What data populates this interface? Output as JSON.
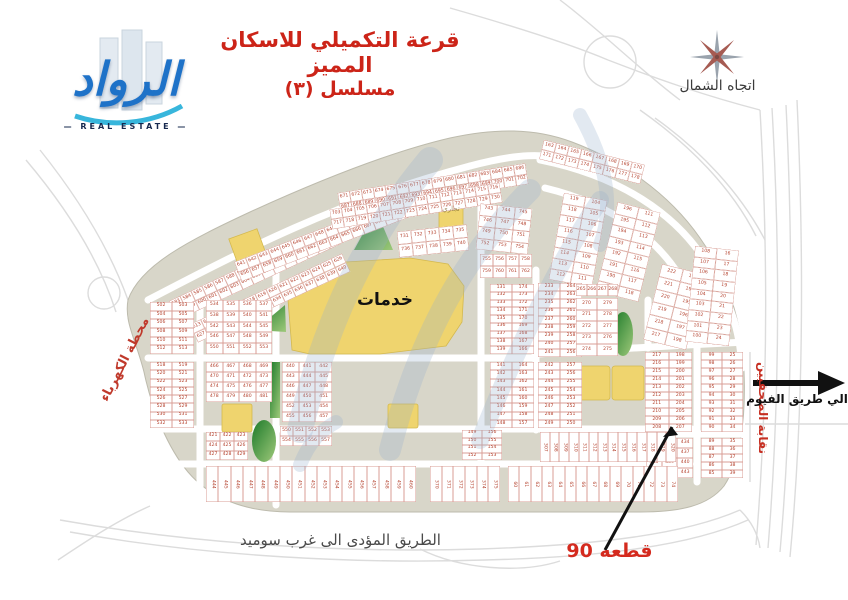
{
  "title": {
    "line1": "قرعة التكميلي للاسكان المميز",
    "line2": "مسلسل (٣)",
    "color": "#cc2418"
  },
  "branding": {
    "logo_text": "الرواد",
    "logo_sub": "REAL ESTATE"
  },
  "compass": {
    "label": "اتجاه الشمال"
  },
  "labels": {
    "services": "خدمات",
    "commercial": "تجاري",
    "power_station": "محطة الكهرباء",
    "journalists_syndicate": "نقابة الصحفيين",
    "to_fayoum_road": "الي طريق الفيوم",
    "road_to_west_sumid": "الطريق المؤدى الى غرب سوميد",
    "plot_90": "قطعه 90"
  },
  "colors": {
    "parcel_fill": "#d8d6c9",
    "parcel_edge": "#bdbbad",
    "road": "#ffffff",
    "highway": "#dcdcdc",
    "plot_number": "#b5432f",
    "plot_border": "rgba(178,62,44,0.5)",
    "services_yellow": "#efd46e",
    "green_dark": "#1d7a2a",
    "green_light": "#9ec97a",
    "watermark": "rgba(150,175,205,0.28)",
    "title_red": "#cc2418",
    "arrow_black": "#111111"
  },
  "map": {
    "blocks": [
      {
        "name": "strip-a",
        "x": 165,
        "y": 262,
        "w": 180,
        "h": 21,
        "rot": -25,
        "rows": 2,
        "cols": 15,
        "from": 583,
        "step": 1
      },
      {
        "name": "strip-b",
        "x": 186,
        "y": 288,
        "w": 168,
        "h": 20,
        "rot": -25,
        "rows": 2,
        "cols": 14,
        "from": 613,
        "step": 1
      },
      {
        "name": "strip-c",
        "x": 232,
        "y": 229,
        "w": 180,
        "h": 21,
        "rot": -21,
        "rows": 2,
        "cols": 15,
        "from": 641,
        "step": 1
      },
      {
        "name": "strip-d",
        "x": 338,
        "y": 178,
        "w": 190,
        "h": 21,
        "rot": -9,
        "rows": 2,
        "cols": 16,
        "from": 671,
        "step": 1
      },
      {
        "name": "strip-e",
        "x": 330,
        "y": 196,
        "w": 172,
        "h": 20,
        "rot": -9,
        "rows": 2,
        "cols": 14,
        "from": 703,
        "step": 1
      },
      {
        "name": "strip-f",
        "x": 540,
        "y": 152,
        "w": 104,
        "h": 20,
        "rot": 14,
        "rows": 2,
        "cols": 8,
        "from": 163,
        "step": 1
      },
      {
        "name": "tr-block-1",
        "x": 556,
        "y": 196,
        "w": 44,
        "h": 88,
        "rot": 10,
        "rows": 8,
        "cols": 2,
        "columns": [
          {
            "from": 119,
            "step": -1
          },
          {
            "from": 104,
            "step": 1
          }
        ]
      },
      {
        "name": "tr-block-2",
        "x": 606,
        "y": 206,
        "w": 44,
        "h": 92,
        "rot": 14,
        "rows": 8,
        "cols": 2,
        "columns": [
          {
            "from": 196,
            "step": -1
          },
          {
            "from": 111,
            "step": 1
          }
        ]
      },
      {
        "name": "arc-block-1",
        "x": 652,
        "y": 268,
        "w": 44,
        "h": 78,
        "rot": 14,
        "rows": 6,
        "cols": 2,
        "columns": [
          {
            "from": 222,
            "step": -1
          },
          {
            "from": 193,
            "step": 1
          }
        ]
      },
      {
        "name": "arc-block-2",
        "x": 690,
        "y": 248,
        "w": 44,
        "h": 96,
        "rot": 6,
        "rows": 9,
        "cols": 2,
        "columns": [
          {
            "from": 108,
            "step": -1
          },
          {
            "from": 16,
            "step": 1
          }
        ]
      },
      {
        "name": "right-col-1",
        "x": 645,
        "y": 352,
        "w": 47,
        "h": 80,
        "rows": 10,
        "cols": 2,
        "columns": [
          {
            "from": 217,
            "step": -1
          },
          {
            "from": 198,
            "step": 1
          }
        ]
      },
      {
        "name": "right-col-2",
        "x": 701,
        "y": 352,
        "w": 42,
        "h": 80,
        "rows": 10,
        "cols": 2,
        "columns": [
          {
            "from": 99,
            "step": -1
          },
          {
            "from": 25,
            "step": 1
          }
        ]
      },
      {
        "name": "right-col-3",
        "x": 701,
        "y": 438,
        "w": 42,
        "h": 40,
        "rows": 5,
        "cols": 2,
        "columns": [
          {
            "from": 89,
            "step": -1
          },
          {
            "from": 35,
            "step": 1
          }
        ]
      },
      {
        "name": "right-small",
        "x": 646,
        "y": 438,
        "w": 47,
        "h": 40,
        "rows": 4,
        "cols": 3,
        "from": 432,
        "step": 1
      },
      {
        "name": "center-col-1",
        "x": 490,
        "y": 284,
        "w": 44,
        "h": 70,
        "rows": 9,
        "cols": 2,
        "columns": [
          {
            "from": 131,
            "step": 1
          },
          {
            "from": 174,
            "step": -1
          }
        ]
      },
      {
        "name": "center-col-2",
        "x": 490,
        "y": 362,
        "w": 44,
        "h": 66,
        "rows": 8,
        "cols": 2,
        "columns": [
          {
            "from": 141,
            "step": 1
          },
          {
            "from": 164,
            "step": -1
          }
        ]
      },
      {
        "name": "center-col-3",
        "x": 462,
        "y": 430,
        "w": 40,
        "h": 30,
        "rows": 4,
        "cols": 2,
        "columns": [
          {
            "from": 149,
            "step": 1
          },
          {
            "from": 156,
            "step": -1
          }
        ]
      },
      {
        "name": "mid-col-1",
        "x": 538,
        "y": 283,
        "w": 44,
        "h": 74,
        "rows": 9,
        "cols": 2,
        "columns": [
          {
            "from": 233,
            "step": 1
          },
          {
            "from": 264,
            "step": -1
          }
        ]
      },
      {
        "name": "mid-col-2",
        "x": 538,
        "y": 362,
        "w": 44,
        "h": 66,
        "rows": 8,
        "cols": 2,
        "columns": [
          {
            "from": 242,
            "step": 1
          },
          {
            "from": 257,
            "step": -1
          }
        ]
      },
      {
        "name": "arch-cap",
        "x": 576,
        "y": 284,
        "w": 42,
        "h": 12,
        "rows": 1,
        "cols": 4,
        "from": 265,
        "step": 1
      },
      {
        "name": "arch-block",
        "x": 576,
        "y": 298,
        "w": 42,
        "h": 58,
        "rows": 5,
        "cols": 2,
        "columns": [
          {
            "from": 270,
            "step": 1
          },
          {
            "from": 279,
            "step": -1
          }
        ]
      },
      {
        "name": "left-col-1",
        "x": 150,
        "y": 302,
        "w": 44,
        "h": 52,
        "rows": 6,
        "cols": 2,
        "from": 502,
        "step": 1
      },
      {
        "name": "left-col-2",
        "x": 150,
        "y": 362,
        "w": 44,
        "h": 66,
        "rows": 8,
        "cols": 2,
        "from": 518,
        "step": 1
      },
      {
        "name": "left-grid-1",
        "x": 206,
        "y": 300,
        "w": 66,
        "h": 54,
        "rows": 5,
        "cols": 4,
        "from": 534,
        "step": 1
      },
      {
        "name": "left-grid-2",
        "x": 206,
        "y": 362,
        "w": 66,
        "h": 40,
        "rows": 4,
        "cols": 4,
        "from": 466,
        "step": 1
      },
      {
        "name": "left-grid-3",
        "x": 206,
        "y": 432,
        "w": 42,
        "h": 28,
        "rows": 3,
        "cols": 3,
        "from": 421,
        "step": 1
      },
      {
        "name": "left-grid-4",
        "x": 282,
        "y": 362,
        "w": 50,
        "h": 60,
        "rows": 6,
        "cols": 3,
        "from": 440,
        "step": 1
      },
      {
        "name": "top-grid-1",
        "x": 398,
        "y": 228,
        "w": 70,
        "h": 26,
        "rot": -6,
        "rows": 2,
        "cols": 5,
        "from": 731,
        "step": 1
      },
      {
        "name": "top-grid-2",
        "x": 478,
        "y": 206,
        "w": 52,
        "h": 46,
        "rot": 6,
        "rows": 4,
        "cols": 3,
        "from": 743,
        "step": 1
      },
      {
        "name": "top-grid-3",
        "x": 480,
        "y": 254,
        "w": 52,
        "h": 24,
        "rows": 2,
        "cols": 4,
        "from": 755,
        "step": 1
      },
      {
        "name": "mid-strip-55x",
        "x": 280,
        "y": 426,
        "w": 52,
        "h": 20,
        "rows": 2,
        "cols": 4,
        "from": 550,
        "step": 1
      },
      {
        "name": "vstrip-300s",
        "x": 540,
        "y": 432,
        "w": 136,
        "h": 30,
        "rows": 1,
        "cols": 14,
        "from": 307,
        "step": 1,
        "vtext": true
      },
      {
        "name": "bottom-strip-1",
        "x": 206,
        "y": 466,
        "w": 210,
        "h": 36,
        "rows": 1,
        "cols": 17,
        "from": 444,
        "step": 1,
        "vtext": true
      },
      {
        "name": "bottom-strip-2",
        "x": 430,
        "y": 466,
        "w": 70,
        "h": 36,
        "rows": 1,
        "cols": 6,
        "from": 370,
        "step": 1,
        "vtext": true
      },
      {
        "name": "bottom-strip-3",
        "x": 508,
        "y": 466,
        "w": 170,
        "h": 36,
        "rows": 1,
        "cols": 15,
        "from": 60,
        "step": 1,
        "vtext": true
      }
    ]
  }
}
